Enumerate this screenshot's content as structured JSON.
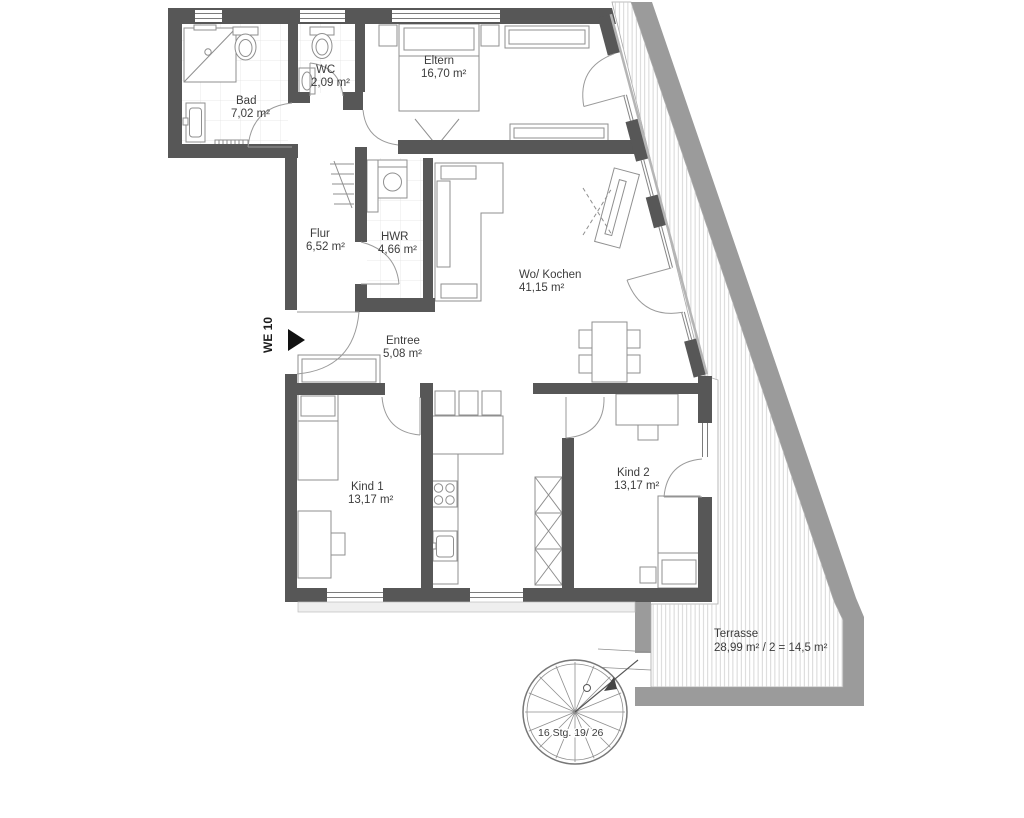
{
  "plan": {
    "unit_label": "WE 10",
    "stair_label": "16 Stg. 19/ 26",
    "rooms": [
      {
        "id": "bad",
        "name": "Bad",
        "area": "7,02 m²"
      },
      {
        "id": "wc",
        "name": "WC",
        "area": "2,09 m²"
      },
      {
        "id": "eltern",
        "name": "Eltern",
        "area": "16,70 m²"
      },
      {
        "id": "flur",
        "name": "Flur",
        "area": "6,52 m²"
      },
      {
        "id": "hwr",
        "name": "HWR",
        "area": "4,66 m²"
      },
      {
        "id": "wo-kochen",
        "name": "Wo/ Kochen",
        "area": "41,15 m²"
      },
      {
        "id": "entree",
        "name": "Entree",
        "area": "5,08 m²"
      },
      {
        "id": "kind1",
        "name": "Kind 1",
        "area": "13,17 m²"
      },
      {
        "id": "kind2",
        "name": "Kind 2",
        "area": "13,17 m²"
      },
      {
        "id": "terrasse",
        "name": "Terrasse",
        "area": "28,99 m² / 2 = 14,5 m²"
      }
    ],
    "colors": {
      "wall": "#575757",
      "terrace_band": "#9b9b9b",
      "hatch_line": "#cccccc",
      "furniture_line": "#8f8f8f",
      "tile_line": "#e3e3e3",
      "door_line": "#9a9a9a",
      "text": "#3c3c3c",
      "background": "#ffffff"
    }
  }
}
